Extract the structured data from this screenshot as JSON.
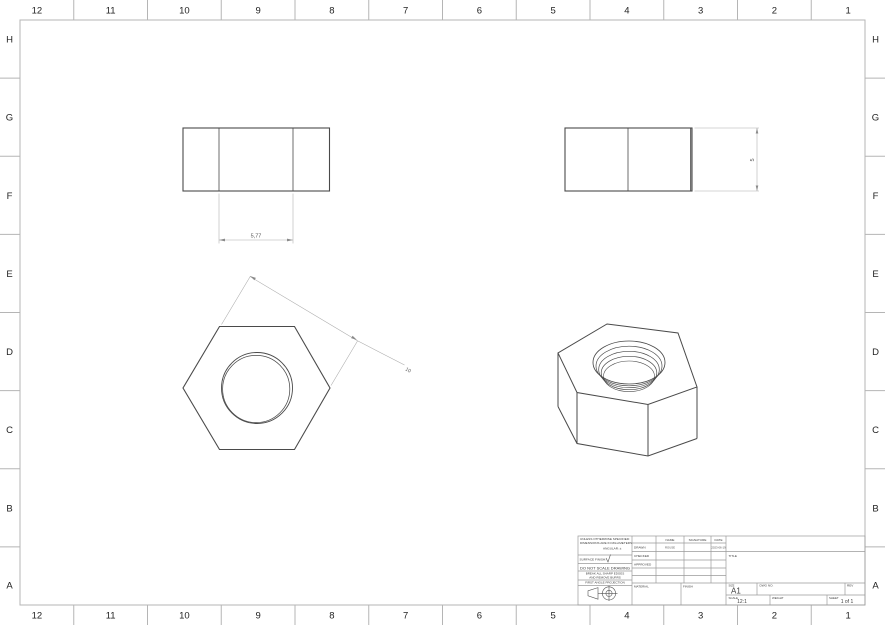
{
  "sheet": {
    "grid_columns": [
      "12",
      "11",
      "10",
      "9",
      "8",
      "7",
      "6",
      "5",
      "4",
      "3",
      "2",
      "1"
    ],
    "grid_rows": [
      "H",
      "G",
      "F",
      "E",
      "D",
      "C",
      "B",
      "A"
    ],
    "background": "#ffffff",
    "frame_color": "#b5b5b5",
    "edge_color": "#4a4a4a",
    "dim_line_color": "#ababab",
    "dim_text_color": "#555555"
  },
  "dimensions": {
    "front_view_width": "5,77",
    "hex_across_flats": "10",
    "side_view_height": "5"
  },
  "title_block": {
    "notes": {
      "line1": "UNLESS OTHERWISE SPECIFIED:",
      "line2": "DIMENSIONS ARE IN MILLIMETERS",
      "line3": "ANGULAR: ±"
    },
    "surface_finish_label": "SURFACE FINISH:",
    "do_not_scale": "DO NOT SCALE DRAWING",
    "deburr_line1": "BREAK ALL SHARP EDGES",
    "deburr_line2": "AND REMOVE BURRS",
    "projection_label": "FIRST ANGLE PROJECTION",
    "table": {
      "name_header": "NAME",
      "signature_header": "SIGNATURE",
      "date_header": "DATE",
      "rows": [
        {
          "label": "DRAWN",
          "name": "ROUSE",
          "signature": "",
          "date": "2023-06-19"
        },
        {
          "label": "CHECKED",
          "name": "",
          "signature": "",
          "date": ""
        },
        {
          "label": "APPROVED",
          "name": "",
          "signature": "",
          "date": ""
        }
      ]
    },
    "material_label": "MATERIAL",
    "finish_label": "FINISH",
    "title_label": "TITLE",
    "size_label": "SIZE",
    "size_value": "A1",
    "dwg_no_label": "DWG NO.",
    "rev_label": "REV",
    "scale_label": "SCALE",
    "scale_value": "12:1",
    "weight_label": "WEIGHT",
    "sheet_label": "SHEET",
    "sheet_value": "1 of 1"
  }
}
